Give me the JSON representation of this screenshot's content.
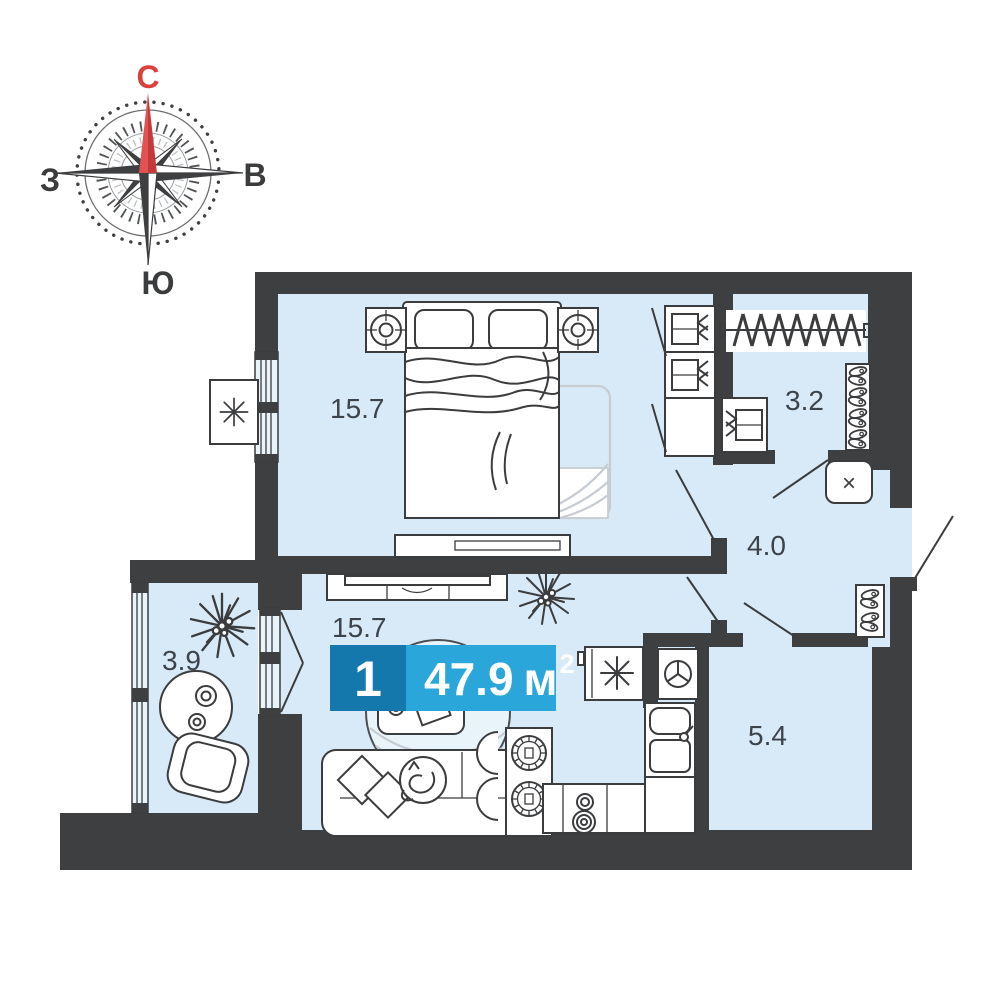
{
  "compass": {
    "north": "С",
    "east": "В",
    "south": "Ю",
    "west": "З"
  },
  "badge": {
    "rooms_count": "1",
    "area_value": "47.9",
    "area_unit": "м",
    "area_superscript": "2"
  },
  "rooms": {
    "bedroom": {
      "area": "15.7"
    },
    "closet": {
      "area": "3.2"
    },
    "hallway": {
      "area": "4.0"
    },
    "kitchen_living": {
      "area": "15.7"
    },
    "balcony": {
      "area": "3.9"
    },
    "bathroom": {
      "area": "5.4"
    }
  },
  "symbols": {
    "water_heater": "×"
  },
  "icons": {
    "compass-rose": "8-point wind-rose star, red north needle, dotted outer ring",
    "fridge-icon": "8-spoke asterisk in box",
    "air-conditioner-icon": "8-spoke asterisk in box outside window",
    "washing-machine-icon": "square with circle and Y drum",
    "water-heater-icon": "rounded square with × glyph",
    "plant-icon": "spiky radial leaves",
    "shoe-pair-icon": "two tilted ovals",
    "hanger-rail-icon": "rod with diagonal hatch clothes",
    "clothes-shelf-icon": "folded clothes stack with chevrons"
  },
  "colors": {
    "wall": "#3e3f41",
    "floor": "#d8eaf7",
    "floor_light": "#e9f3fa",
    "line": "#3b3c3e",
    "soft": "#c7ccd2",
    "accent_dark": "#1478ad",
    "accent_light": "#2ba6db",
    "label": "#3d434a",
    "compass_red": "#d9413d"
  }
}
